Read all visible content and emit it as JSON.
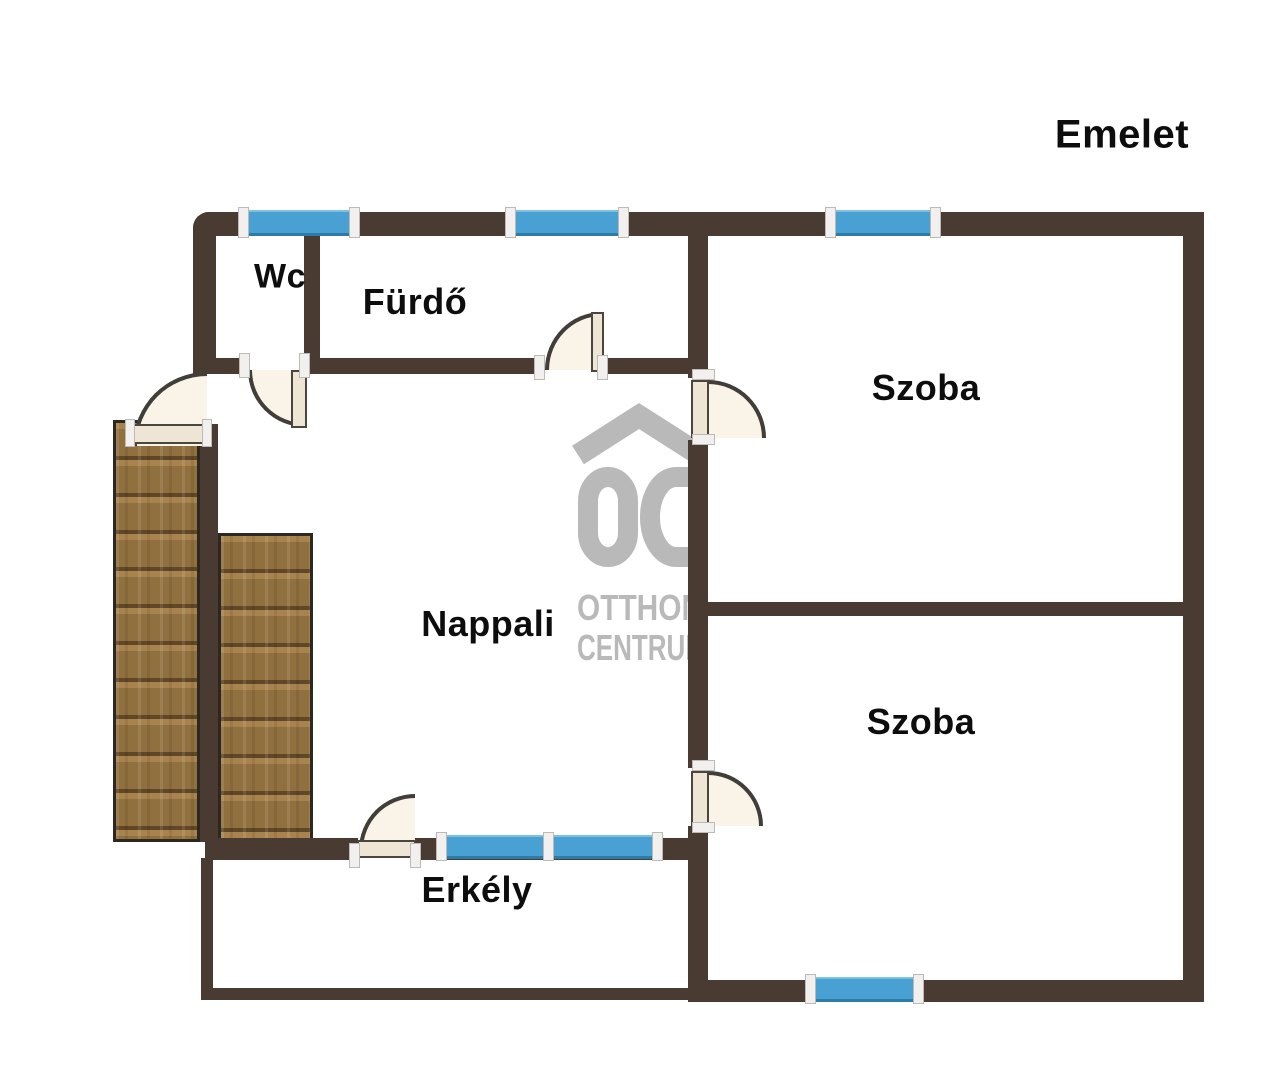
{
  "title": "Emelet",
  "rooms": {
    "wc": "Wc",
    "furdo": "Fürdő",
    "szoba_felso": "Szoba",
    "nappali": "Nappali",
    "szoba_also": "Szoba",
    "erkely": "Erkély"
  },
  "watermark": {
    "line1": "OTTHON",
    "line2": "CENTRUM"
  },
  "colors": {
    "wall": "#4a3b32",
    "window_blue": "#49a0d2",
    "door_fill": "#faf3e8",
    "stair_wood": "#91703f",
    "watermark_gray": "#b9b9b9",
    "label_text": "#0d0d0d"
  }
}
